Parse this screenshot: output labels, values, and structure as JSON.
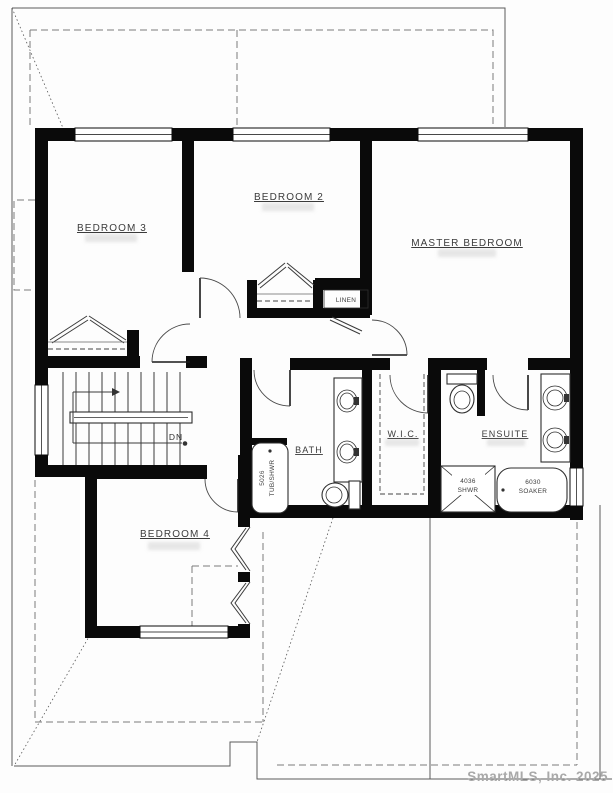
{
  "plan": {
    "rooms": {
      "bedroom3": "BEDROOM 3",
      "bedroom2": "BEDROOM 2",
      "master": "MASTER BEDROOM",
      "bedroom4": "BEDROOM 4",
      "bath": "BATH",
      "wic": "W.I.C.",
      "ensuite": "ENSUITE",
      "linen": "LINEN"
    },
    "fixtures": {
      "tub_size": "5026",
      "tub_type": "TUB/SHWR",
      "shower_size": "4036",
      "shower_type": "SHWR",
      "soaker_size": "6030",
      "soaker_type": "SOAKER"
    },
    "stairs": {
      "direction": "DN"
    },
    "watermark": "SmartMLS, Inc. 2025"
  }
}
